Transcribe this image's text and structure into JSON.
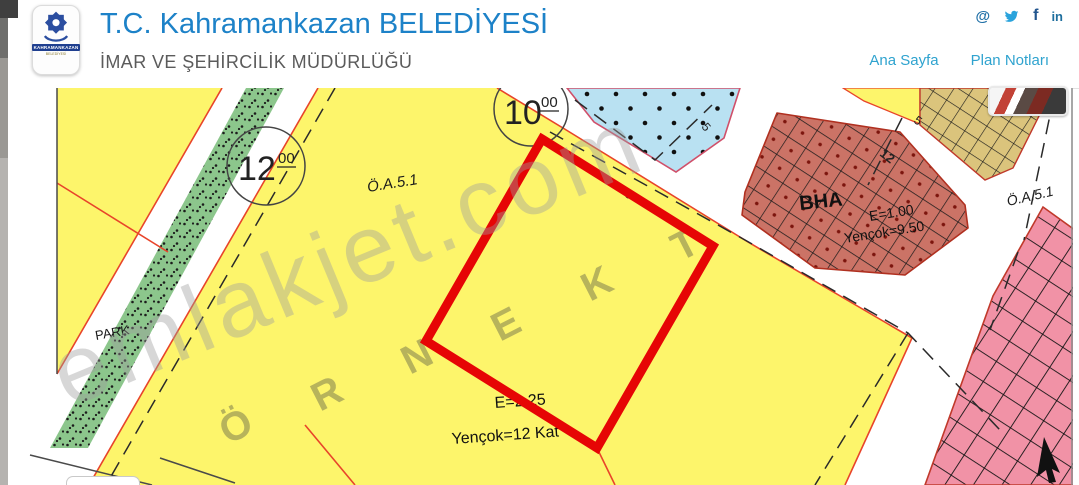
{
  "header": {
    "title": "T.C. Kahramankazan BELEDİYESİ",
    "subtitle": "İMAR VE ŞEHİRCİLİK MÜDÜRLÜĞÜ",
    "title_color": "#1d82c8",
    "logo": {
      "line1": "KAHRAMANKAZAN",
      "line2": "BELEDİYESİ"
    },
    "nav": [
      {
        "label": "Ana Sayfa"
      },
      {
        "label": "Plan Notları"
      }
    ],
    "social": [
      {
        "name": "email-icon",
        "glyph": "@"
      },
      {
        "name": "twitter-icon"
      },
      {
        "name": "facebook-icon",
        "glyph": "f"
      },
      {
        "name": "linkedin-icon",
        "glyph": "in"
      }
    ]
  },
  "map": {
    "watermark": "emlakjet.com",
    "sample": [
      "Ö",
      "R",
      "N",
      "E",
      "K",
      "T"
    ],
    "park_label": "PARK",
    "parcel_label_1": "Ö.A.5.1",
    "parcel_label_2": "Ö.A.5.1",
    "target": {
      "e": "E=2.25",
      "yencok": "Yençok=12 Kat"
    },
    "bha": {
      "name": "BHA",
      "e": "E=1.00",
      "yencok": "Yençok=9.50"
    },
    "road_circles": [
      {
        "value": "12",
        "sup": "00"
      },
      {
        "value": "10",
        "sup": "00"
      }
    ],
    "dims": {
      "d5_blue": "5",
      "d5_mid": "5",
      "d5_tan": "5",
      "d12": "12"
    },
    "colors": {
      "parcel_yellow": "#fdf56b",
      "park_green": "#8cc68c",
      "social_blue": "#b9e1f2",
      "bha_red": "#cb7366",
      "tan": "#dbc47c",
      "pink": "#f192a6",
      "highlight_red": "#e60505",
      "parcel_line_red": "#e8442a"
    }
  }
}
